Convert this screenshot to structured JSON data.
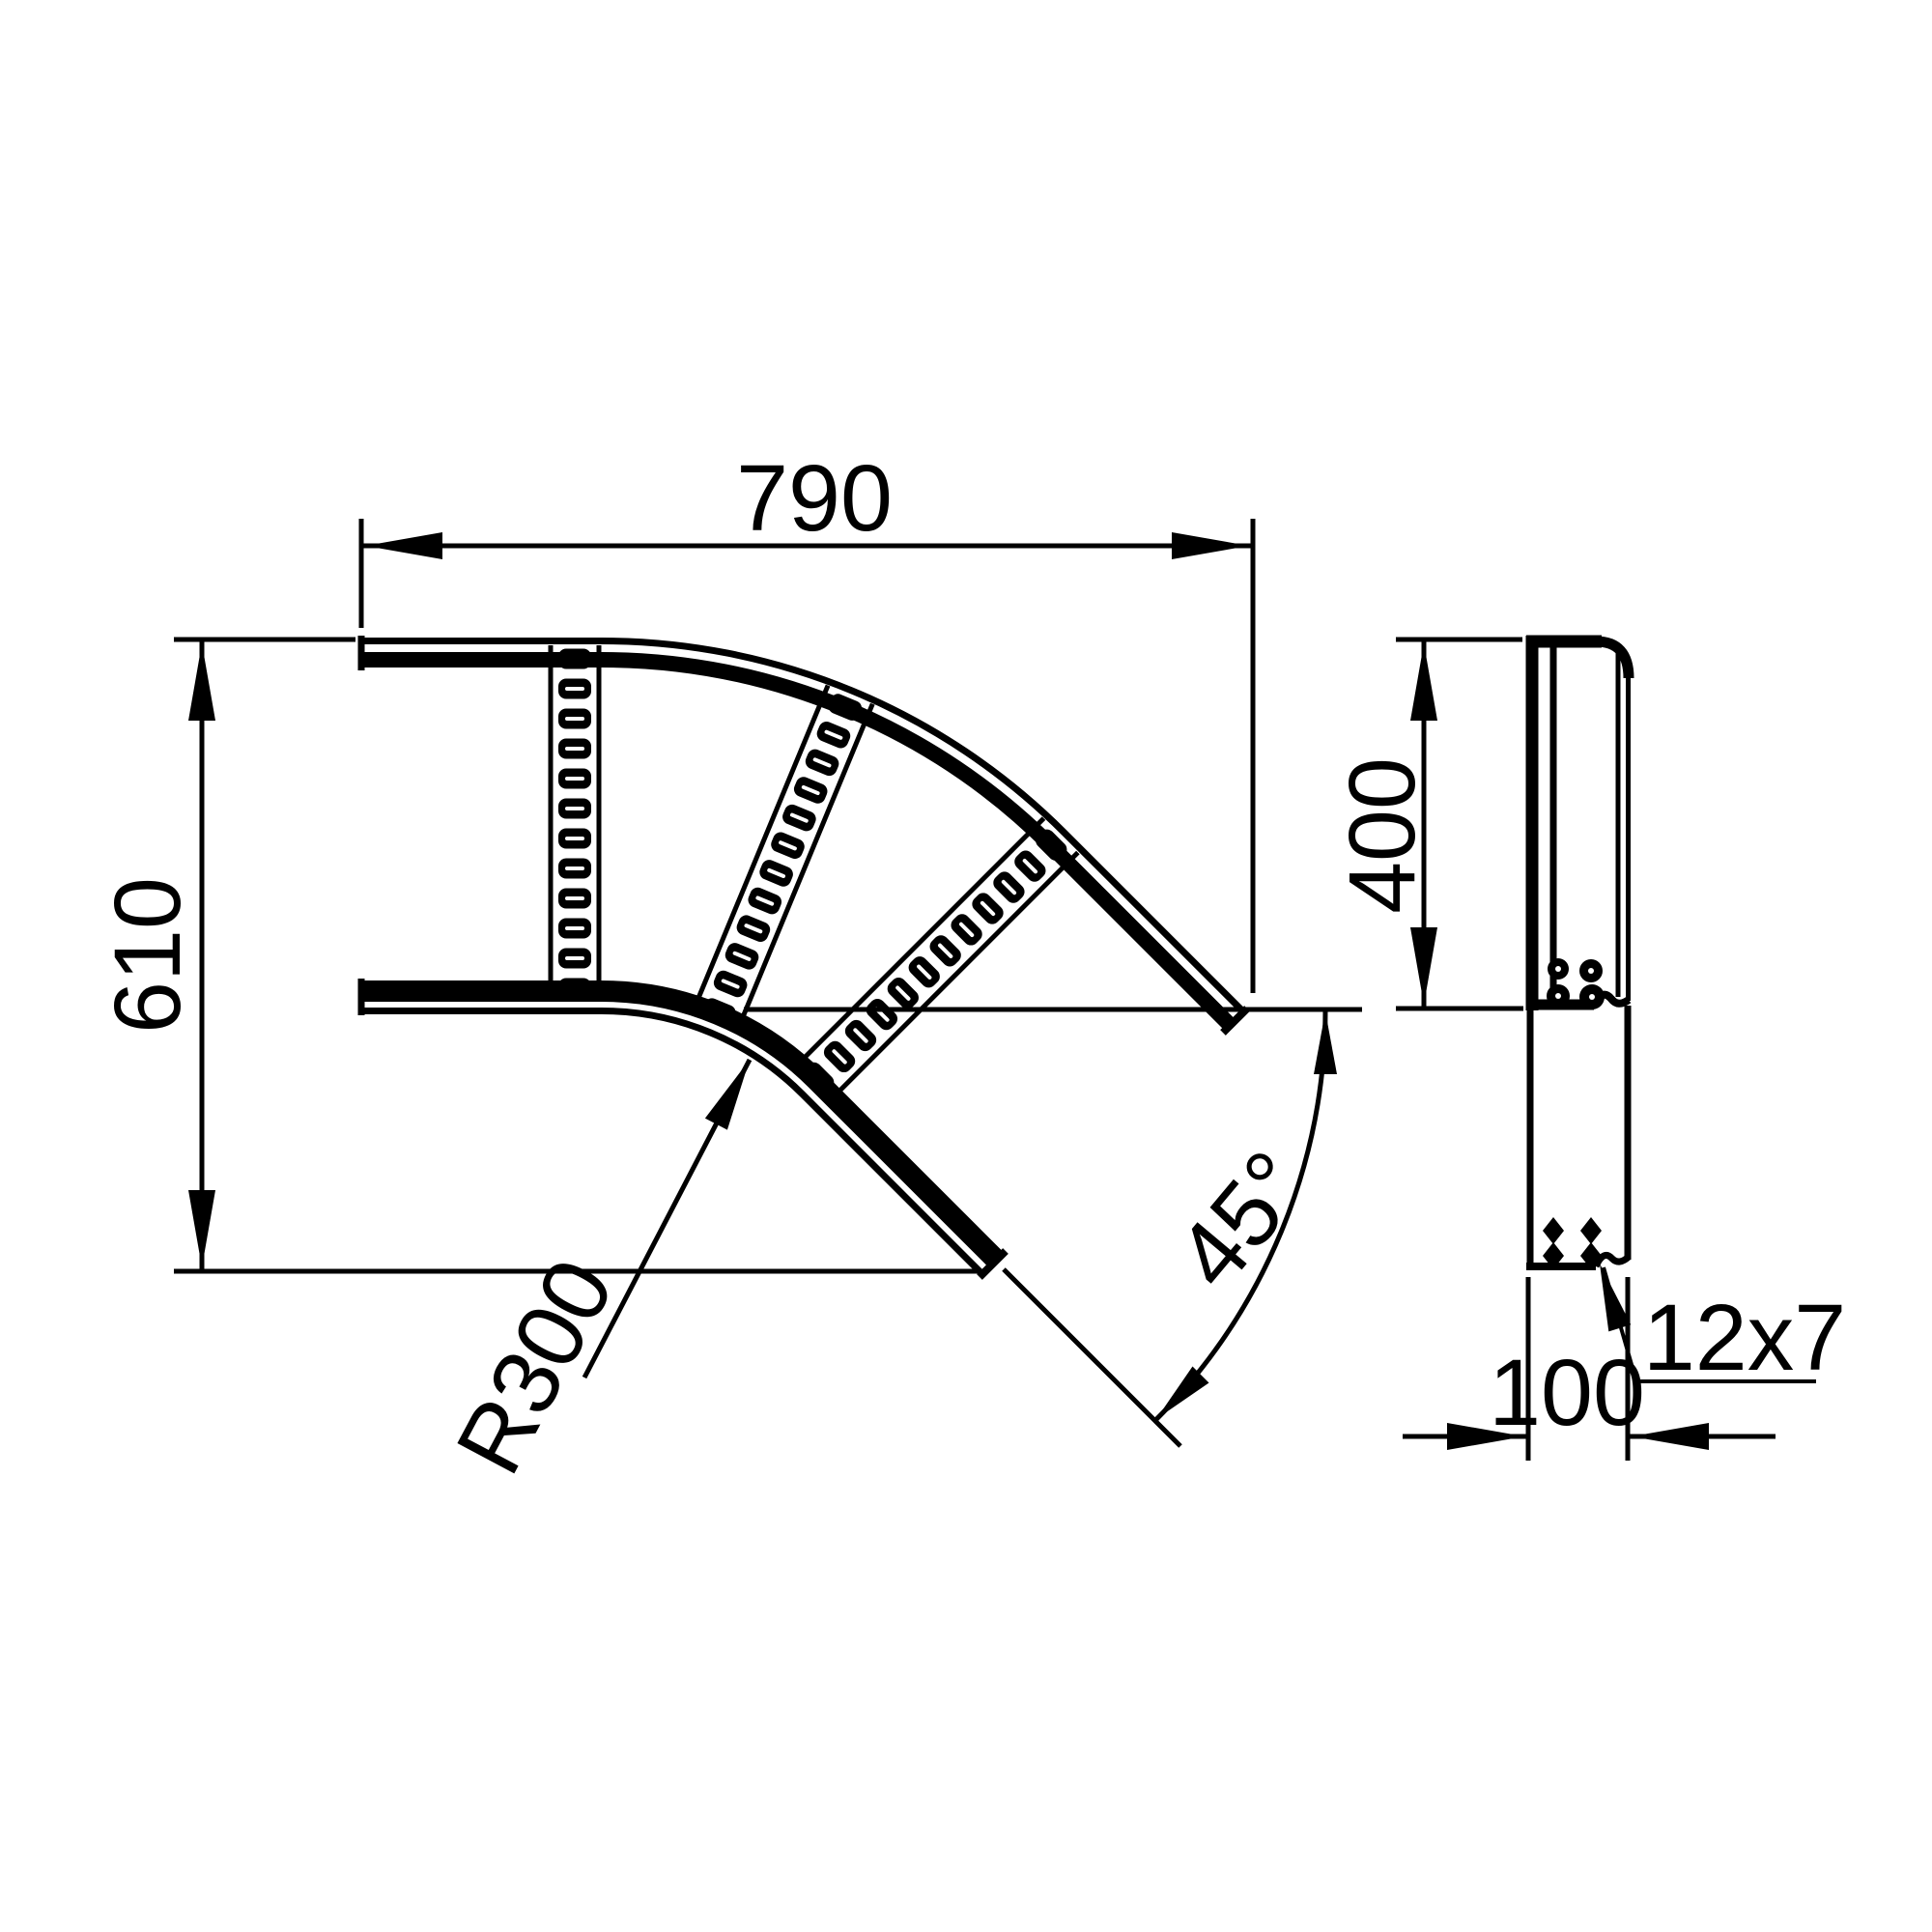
{
  "drawing": {
    "kind": "technical-drawing",
    "subject": "45 degree cable ladder bend, plan view and side profile view",
    "background_color": "#ffffff",
    "line_color": "#000000",
    "plan_view": {
      "rung_count": 3,
      "dim_width": {
        "label": "790"
      },
      "dim_height": {
        "label": "610"
      },
      "dim_radius": {
        "label": "R300"
      },
      "dim_angle": {
        "label": "45°"
      }
    },
    "side_view": {
      "dim_length": {
        "label": "400"
      },
      "dim_profile": {
        "label": "100"
      },
      "dim_slot": {
        "label": "12x7"
      }
    }
  }
}
